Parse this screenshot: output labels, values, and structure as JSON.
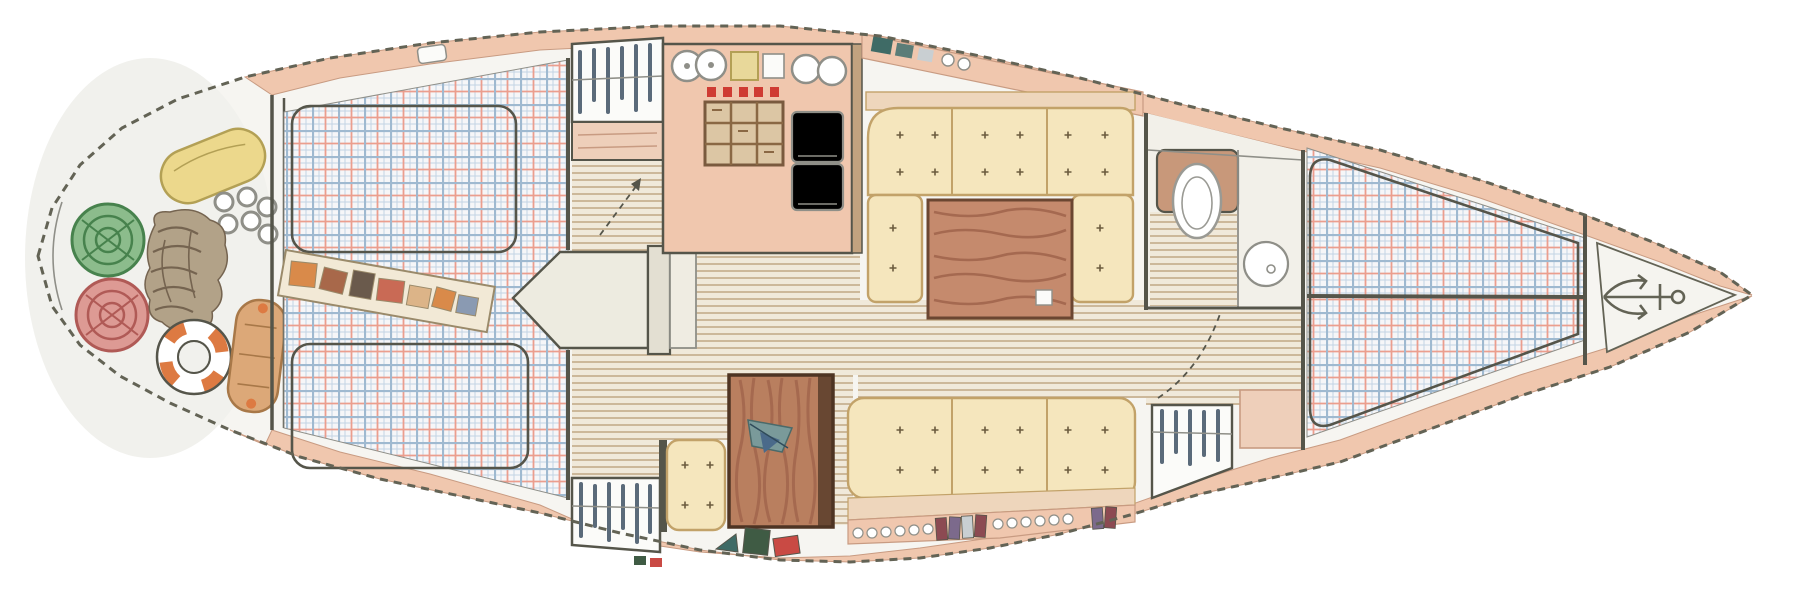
{
  "title": "Hand-drawn interior floor plan of a sailing yacht, top view, stern at left and bow at right",
  "visible_text": "none",
  "canvas": {
    "width": 1807,
    "height": 595
  },
  "palette": {
    "paper": "#ffffff",
    "hullFill": "#f6f5f1",
    "sternFill": "#f1f1ed",
    "deck": "#f0c7ae",
    "deckEdge": "#c89b82",
    "outline": "#636355",
    "wall": "#55554a",
    "wood": "#c2a27f",
    "woodDark": "#7a5a3e",
    "soleBase": "#f0e9da",
    "soleLine": "#b99d78",
    "plaidBase": "#f6f6f8",
    "plaidBlue": "#9fb9d0",
    "plaidRed": "#eb9e8e",
    "plaidFine": "#c3d4e4",
    "cushion": "#f5e6bd",
    "cushionEdge": "#c2a269",
    "tuft": "#6b5b3e",
    "backrest": "#eed6bc",
    "tableWood": "#c58a6d",
    "tableGrain": "#9c6049",
    "tableEdge": "#6b4631",
    "chartTable": "#b97f5f",
    "chartTableEdge": "#4e3423",
    "white": "#fbfbf9",
    "grayEdge": "#8f8f88",
    "stoveRed": "#cf3b33",
    "stoveBg": "#dcc6a4",
    "stoveGrid": "#8a6844",
    "board": "#e8d89a",
    "fenderYellow": "#ecd88c",
    "fenderYellowEdge": "#b3a055",
    "fenderTan": "#dca878",
    "fenderTanEdge": "#a87848",
    "coilGreen": "#8cbc8c",
    "coilGreenDark": "#47824d",
    "coilRed": "#dd9a94",
    "coilRedDark": "#b05a56",
    "ringOrange": "#dd7a42",
    "rope": "#b2a288",
    "ropeDark": "#756450",
    "shelf": "#f2e9d6",
    "shelfEdge": "#9a8a6a",
    "toiletWood": "#c8987a",
    "toiletEdge": "#9a9a94",
    "counter": "#f2f0e9",
    "peachCab": "#eecfba",
    "hanger": "#5a6a7a",
    "bookMaroon": "#8c4a52",
    "bookPurple": "#7c6a8c",
    "bookGray": "#c9cfd2",
    "bookTeal": "#3f6b66",
    "bookRed": "#c94a44",
    "bookGreen": "#3f5b44",
    "itemOrange": "#d98a4a",
    "itemBrown": "#a8684a",
    "itemDark": "#6a5a4c",
    "itemRust": "#c96a55",
    "itemTan": "#dcb488",
    "itemBlue": "#8a9ab2"
  },
  "sections": [
    {
      "name": "stern-deck",
      "position": "far left, rounded stern",
      "fixtures": [
        "yellow-fender",
        "green-coiled-line",
        "red-coiled-line",
        "rope-chain-pile",
        "life-ring",
        "tan-fender",
        "shackle-rings-cluster"
      ]
    },
    {
      "name": "aft-cabin",
      "position": "left",
      "fixtures": [
        "double-berth-plaid-bedding",
        "two-mattress-outlines",
        "stowage-shelf-with-gear",
        "pointed-berth-extension-table"
      ]
    },
    {
      "name": "companionway-passage",
      "position": "center-left",
      "fixtures": [
        "hanging-locker-top",
        "drawer-unit",
        "hanging-locker-bottom",
        "striped-cabin-sole",
        "entry-arrow"
      ]
    },
    {
      "name": "galley",
      "position": "top center",
      "fixtures": [
        "double-sink",
        "cutting-board",
        "stove-with-five-red-knobs",
        "oven-grate",
        "second-double-sink",
        "two-door-refrigerator"
      ]
    },
    {
      "name": "salon-dinette",
      "position": "center",
      "fixtures": [
        "u-shaped-settee-tufted-cushions",
        "wood-dining-table",
        "straight-settee",
        "bookshelf-with-books",
        "overhead-lockers"
      ]
    },
    {
      "name": "nav-station",
      "position": "bottom center",
      "fixtures": [
        "chart-table-wood",
        "charts-and-dividers",
        "tufted-seat",
        "book-row"
      ]
    },
    {
      "name": "head",
      "position": "upper right of salon",
      "fixtures": [
        "toilet",
        "round-wash-basin",
        "counter",
        "striped-sole",
        "door-swing-arc",
        "lower-cabinet",
        "hanging-locker"
      ]
    },
    {
      "name": "forward-cabin",
      "position": "right",
      "fixtures": [
        "v-berth-plaid-bedding",
        "center-seam"
      ]
    },
    {
      "name": "anchor-locker",
      "position": "bow tip, far right",
      "fixtures": [
        "anchor"
      ]
    }
  ]
}
